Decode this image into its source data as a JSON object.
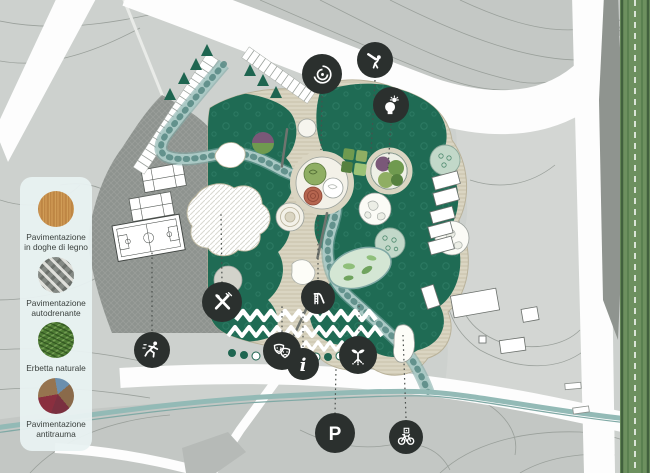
{
  "title": "Park master plan",
  "legend": {
    "items": [
      {
        "label": "Pavimentazione in doghe di legno",
        "swatch": "wood-decking"
      },
      {
        "label": "Pavimentazione autodrenante",
        "swatch": "permeable-paving"
      },
      {
        "label": "Erbetta naturale",
        "swatch": "natural-grass"
      },
      {
        "label": "Pavimentazione antitrauma",
        "swatch": "safety-rubber-paving"
      }
    ]
  },
  "map": {
    "icons": [
      {
        "label": "labyrinth"
      },
      {
        "label": "stargazing"
      },
      {
        "label": "idea-lab"
      },
      {
        "label": "running"
      },
      {
        "label": "picnic-area"
      },
      {
        "label": "playground-slide"
      },
      {
        "label": "theater"
      },
      {
        "label": "info-point"
      },
      {
        "label": "educational-garden"
      },
      {
        "label": "parking"
      },
      {
        "label": "bike-parking"
      }
    ]
  },
  "colors": {
    "terrain": "#cdd1ce",
    "park_green": "#1f6b54",
    "paving": "#dad5c2",
    "stream": "#93bab6",
    "icon_background": "#2b302e",
    "legend_background": "#e9f2f2",
    "tree_lane": "#6d905f"
  }
}
